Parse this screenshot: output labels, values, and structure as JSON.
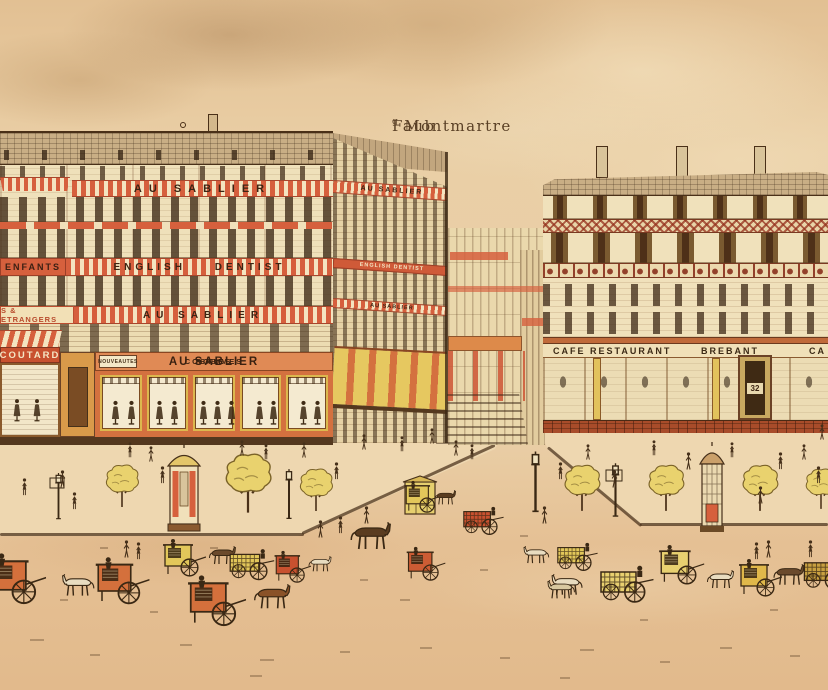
{
  "title": {
    "prefix": "Faub",
    "sup": "g",
    "rest": "Montmartre"
  },
  "left_building": {
    "awning_banner": "AU SABLIER",
    "side_banner": "AU SABLIER",
    "band_kids": "ENFANTS",
    "band_dentist": "ENGLISH DENTIST",
    "side_band_dentist": "ENGLISH DENTIST",
    "band_fabrics": "S & ETRANGERS",
    "band_store": "AU SABLIER",
    "side_band_store": "AU SABLIER",
    "fascia": {
      "panel": "NOUVEAUTES",
      "left": "COSTUMES",
      "name": "AU SABLIER",
      "right": "ROBES"
    }
  },
  "corner_shop": {
    "fascia": "COUTARD"
  },
  "right_building": {
    "fascia_left": "CAFE RESTAURANT",
    "fascia_center": "BREBANT",
    "fascia_right": "CA",
    "door_number": "32"
  },
  "palette": {
    "paper": "#e7cba2",
    "ink": "#46301a",
    "red": "#d6603d",
    "salmon": "#e08a55",
    "yellow": "#e9d170",
    "cream": "#f1e3bd",
    "brick": "#b04f2e"
  }
}
